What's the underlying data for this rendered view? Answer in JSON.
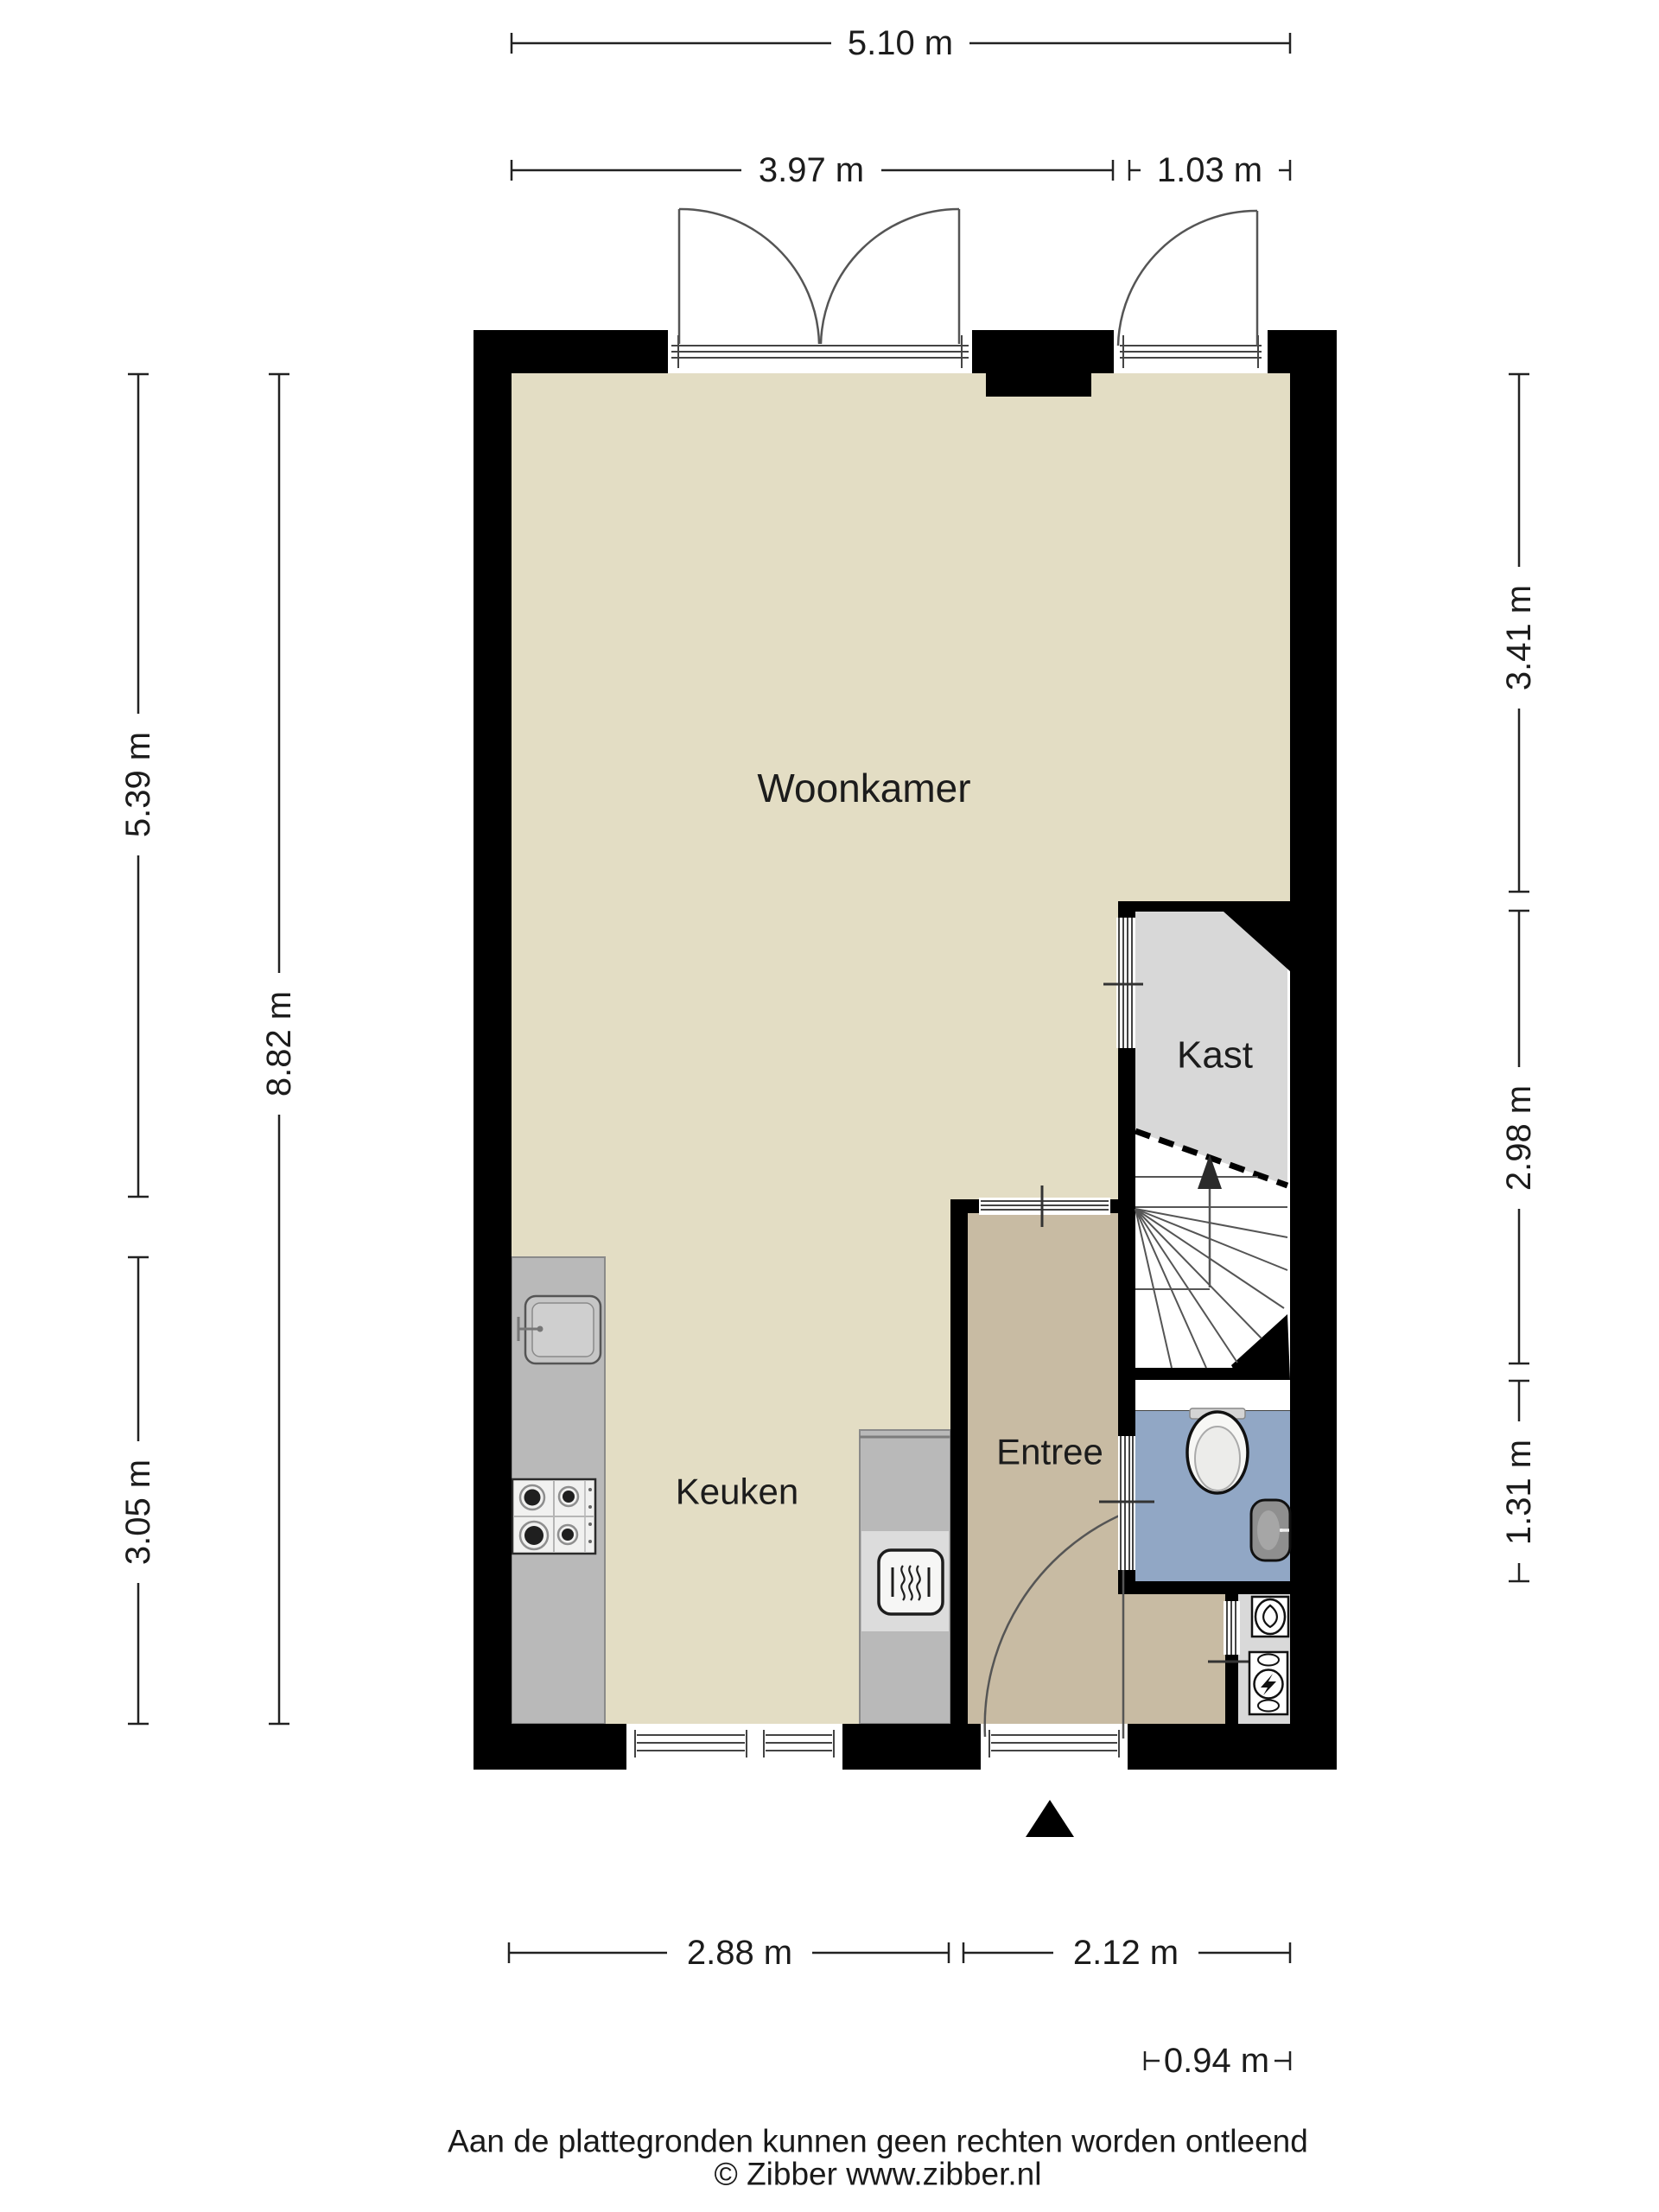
{
  "colors": {
    "wall": "#000000",
    "floor_main": "#E3DDC4",
    "floor_entree": "#C8BBA3",
    "floor_kast": "#D8D8D8",
    "floor_bathroom": "#91A7C5",
    "floor_closet": "#D9D9D9",
    "counter": "#B9B9B9"
  },
  "rooms": {
    "living": {
      "label": "Woonkamer"
    },
    "kitchen": {
      "label": "Keuken"
    },
    "entrance": {
      "label": "Entree"
    },
    "closet": {
      "label": "Kast"
    }
  },
  "dimensions": {
    "top_total": "5.10 m",
    "top_left": "3.97 m",
    "top_right": "1.03 m",
    "left_upper": "5.39 m",
    "left_total": "8.82 m",
    "left_lower": "3.05 m",
    "right_upper": "3.41 m",
    "right_middle": "2.98 m",
    "right_lower": "1.31 m",
    "bottom_left": "2.88 m",
    "bottom_right": "2.12 m",
    "bottom_bathroom": "0.94 m"
  },
  "footer": {
    "disclaimer": "Aan de plattegronden kunnen geen rechten worden ontleend",
    "copyright": "© Zibber www.zibber.nl"
  }
}
